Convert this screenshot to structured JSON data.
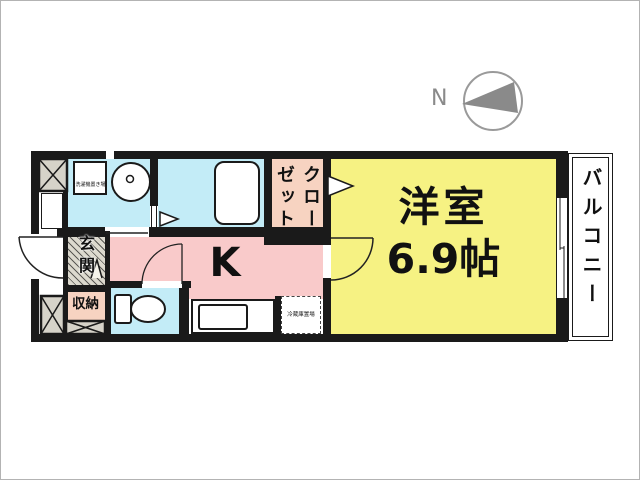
{
  "compass": {
    "label": "N"
  },
  "rooms": {
    "main": {
      "name": "洋室",
      "size": "6.9帖"
    },
    "kitchen": {
      "label": "K"
    },
    "closet": {
      "label": "クローゼット"
    },
    "balcony": {
      "label": "バルコニー"
    },
    "entrance": {
      "label": "玄関"
    },
    "storage": {
      "label": "収納"
    }
  },
  "fixtures": {
    "washer": {
      "label": "洗濯機置き場"
    },
    "fridge": {
      "label": "冷蔵庫置場"
    }
  },
  "colors": {
    "wall": "#1a1a1a",
    "room_yellow": "#f6f283",
    "kitchen_pink": "#f9caca",
    "wet_area_cyan": "#c3ecf7",
    "closet_salmon": "#f7d3c1",
    "shaft_gray": "#d6d3c9",
    "compass_gray": "#8a8a8a"
  }
}
